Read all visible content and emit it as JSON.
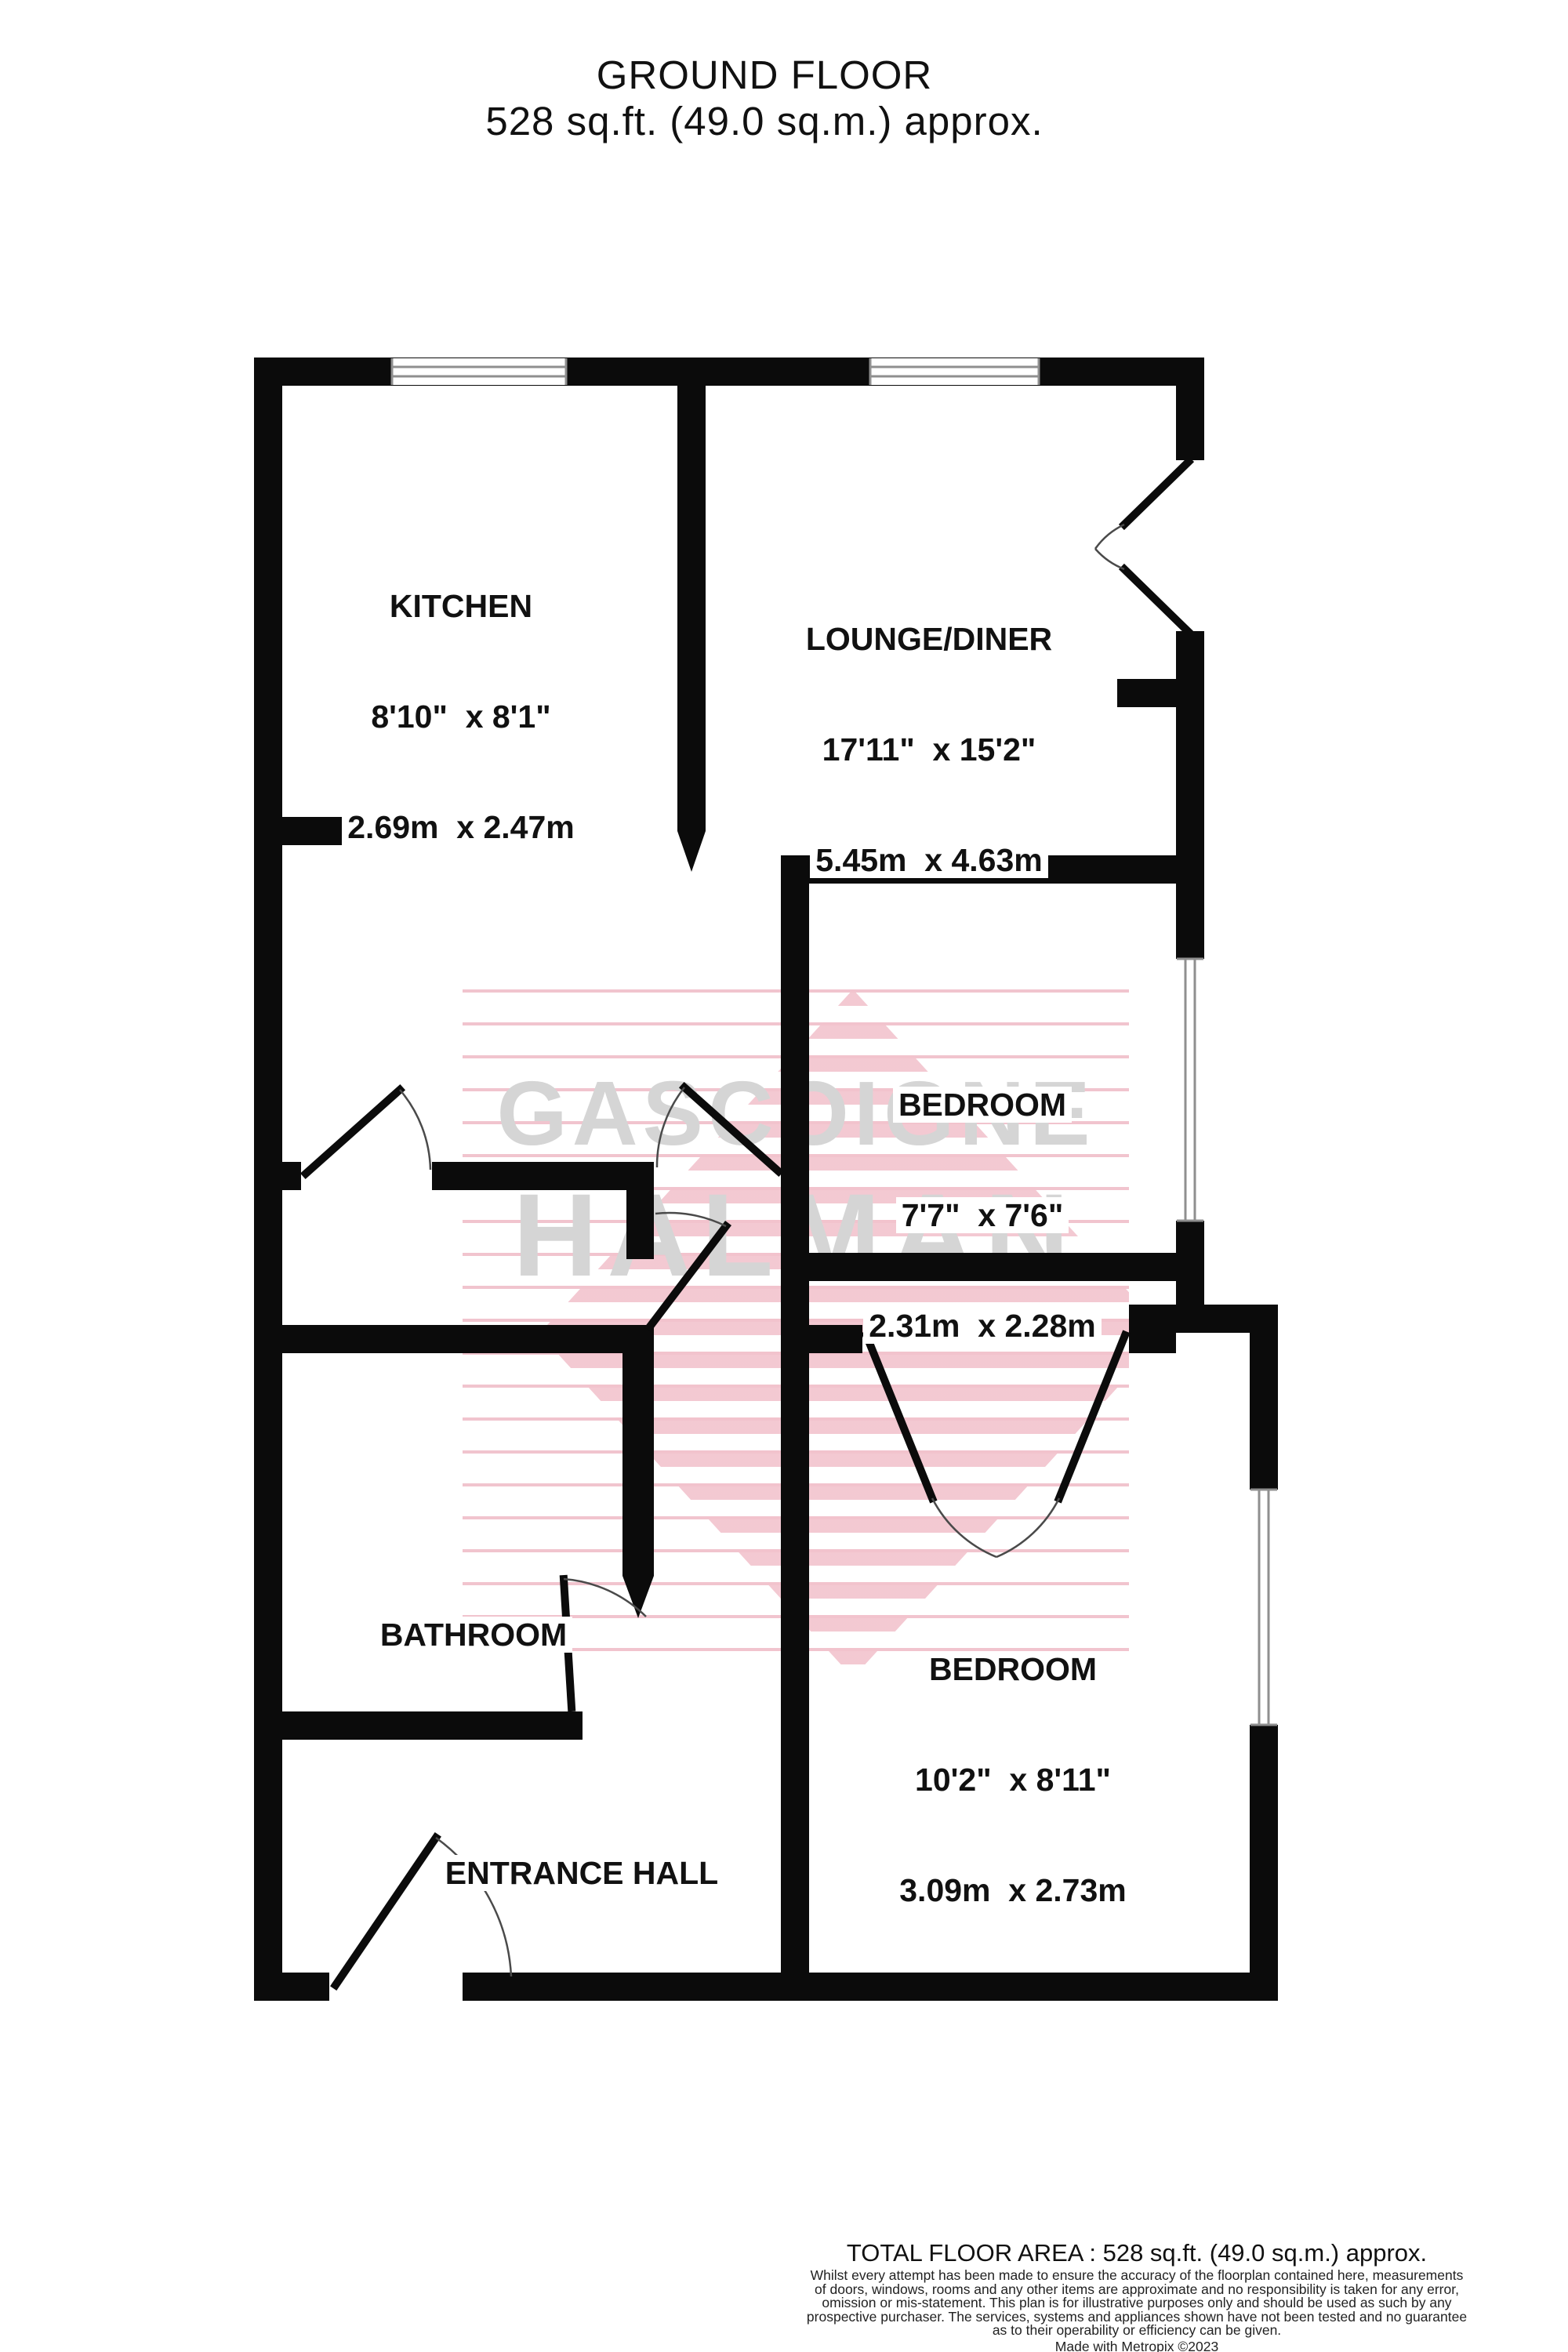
{
  "title": {
    "line1": "GROUND FLOOR",
    "line2": "528 sq.ft. (49.0 sq.m.) approx."
  },
  "watermark": {
    "line1": "GASCOIGNE",
    "line2": "HALMAN"
  },
  "rooms": {
    "kitchen": {
      "name": "KITCHEN",
      "imperial": "8'10\"  x 8'1\"",
      "metric": "2.69m  x 2.47m"
    },
    "lounge": {
      "name": "LOUNGE/DINER",
      "imperial": "17'11\"  x 15'2\"",
      "metric": "5.45m  x 4.63m"
    },
    "bedroom1": {
      "name": "BEDROOM",
      "imperial": "7'7\"  x 7'6\"",
      "metric": "2.31m  x 2.28m"
    },
    "bedroom2": {
      "name": "BEDROOM",
      "imperial": "10'2\"  x 8'11\"",
      "metric": "3.09m  x 2.73m"
    },
    "bathroom": {
      "name": "BATHROOM"
    },
    "entrance_hall": {
      "name": "ENTRANCE HALL"
    }
  },
  "footer": {
    "total": "TOTAL FLOOR AREA : 528 sq.ft. (49.0 sq.m.) approx.",
    "disclaimer": [
      "Whilst every attempt has been made to ensure the accuracy of the floorplan contained here, measurements",
      "of doors, windows, rooms and any other items are approximate and no responsibility is taken for any error,",
      "omission or mis-statement. This plan is for illustrative purposes only and should be used as such by any",
      "prospective purchaser. The services, systems and appliances shown have not been tested and no guarantee",
      "as to their operability or efficiency can be given."
    ],
    "credit": "Made with Metropix ©2023"
  },
  "colors": {
    "wall": "#0b0b0b",
    "watermark_text": "#d5d5d5",
    "watermark_stripe": "#f2c3cd",
    "door_arc": "#4a4a4a"
  }
}
